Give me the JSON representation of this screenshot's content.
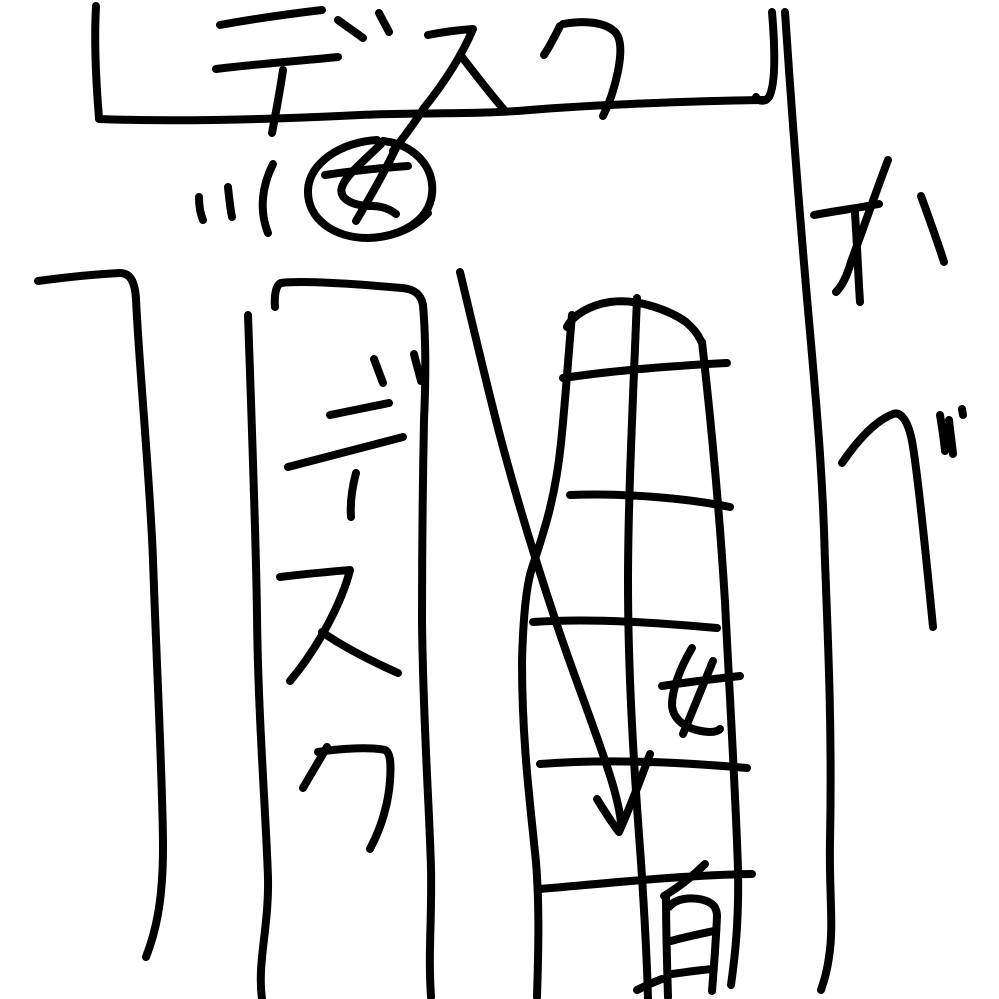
{
  "drawing": {
    "background": "#ffffff",
    "ink_color": "#000000",
    "stroke_width": 8,
    "canvas": {
      "width": 999,
      "height": 999
    },
    "labels": {
      "top_desk": "デスク",
      "circled_person": "女",
      "column_desk": "デスク",
      "wall": "かべ",
      "shelf_person": "女",
      "bottom_kanji": "有"
    },
    "strokes": [
      {
        "name": "top-desk-left-edge",
        "d": "M96,6 C94,42 96,82 99,118"
      },
      {
        "name": "top-desk-bottom-edge",
        "d": "M99,119 C180,122 280,119 360,115 C430,112 470,115 530,110 C590,105 690,101 766,100"
      },
      {
        "name": "top-desk-right-hook",
        "d": "M772,12 C775,48 776,84 769,97 C765,102 759,102 756,97"
      },
      {
        "name": "label-top-desk-de-h1",
        "d": "M220,25 C253,19 288,14 322,10"
      },
      {
        "name": "label-top-desk-de-h2",
        "d": "M216,69 C257,64 298,61 338,57"
      },
      {
        "name": "label-top-desk-de-v",
        "d": "M283,70 C280,91 276,112 272,133"
      },
      {
        "name": "label-top-desk-dakuten-1",
        "d": "M338,20 C346,26 355,32 363,38"
      },
      {
        "name": "label-top-desk-dakuten-2",
        "d": "M379,13 C382,19 386,26 389,32"
      },
      {
        "name": "label-top-desk-su",
        "d": "M428,35 C443,32 458,30 473,29 C462,55 444,83 424,108 C415,122 404,137 393,151"
      },
      {
        "name": "label-top-desk-su-leg",
        "d": "M462,57 C475,74 489,92 505,111"
      },
      {
        "name": "label-top-desk-ku-1",
        "d": "M560,26 C555,36 550,46 544,55"
      },
      {
        "name": "label-top-desk-ku-2",
        "d": "M563,24 C585,20 606,22 616,33 C622,41 621,56 618,71 C615,86 610,102 603,116"
      },
      {
        "name": "speed-line-1",
        "d": "M199,197 C199,205 200,213 203,220"
      },
      {
        "name": "speed-line-2",
        "d": "M228,187 C229,197 230,207 232,217"
      },
      {
        "name": "speed-line-3",
        "d": "M273,164 C262,186 259,210 268,233"
      },
      {
        "name": "person-circle-outline",
        "d": "M377,140 C341,142 309,163 308,190 C307,219 334,238 368,238 C401,237 429,221 432,194 C435,166 413,144 383,141"
      },
      {
        "name": "person-circle-overlap",
        "d": "M428,213 C419,223 407,230 396,233"
      },
      {
        "name": "person-circle-onna-1",
        "d": "M381,144 C365,160 346,175 342,187 C338,199 353,206 372,206 C383,206 391,210 396,214"
      },
      {
        "name": "person-circle-onna-2",
        "d": "M397,146 C385,171 371,196 356,221"
      },
      {
        "name": "person-circle-onna-3",
        "d": "M325,175 C352,171 380,168 408,166"
      },
      {
        "name": "left-desk-outline",
        "d": "M38,281 C68,277 98,274 120,273 C131,273 135,283 136,299 C139,365 150,480 153,560 C157,675 163,790 163,848 C163,903 155,934 146,957"
      },
      {
        "name": "column-desk-left-edge",
        "d": "M248,315 C252,430 256,540 257,615 C258,715 266,815 268,878 C269,928 257,962 262,999"
      },
      {
        "name": "column-desk-top-right-edge",
        "d": "M275,307 C274,295 276,285 281,283 C303,280 356,284 402,288 C414,289 421,294 423,305 C426,340 426,375 424,420 C422,520 422,570 422,620 C423,720 429,800 431,868 C432,922 428,952 431,997"
      },
      {
        "name": "label-column-dakuten-1",
        "d": "M374,359 C377,367 380,375 383,383"
      },
      {
        "name": "label-column-dakuten-2",
        "d": "M414,354 C416,363 419,372 421,381"
      },
      {
        "name": "label-column-de-h1",
        "d": "M330,415 C350,411 369,407 389,403"
      },
      {
        "name": "label-column-de-h2",
        "d": "M288,467 C326,457 365,447 403,437"
      },
      {
        "name": "label-column-de-v",
        "d": "M356,473 C352,488 350,503 351,517"
      },
      {
        "name": "label-column-su",
        "d": "M280,577 C303,574 327,572 350,570 C342,602 318,648 290,681"
      },
      {
        "name": "label-column-su-leg",
        "d": "M322,632 C345,648 371,661 398,673"
      },
      {
        "name": "label-column-ku-1",
        "d": "M327,747 C319,761 311,774 303,788"
      },
      {
        "name": "label-column-ku-2",
        "d": "M318,752 C342,748 372,747 385,750 C391,753 391,766 390,781 C388,806 380,830 370,849"
      },
      {
        "name": "shelf-left-edge",
        "d": "M572,315 C568,360 565,405 561,443 C555,502 542,537 532,568 C526,586 523,622 522,662 C522,742 530,802 536,862 C540,912 538,962 537,997"
      },
      {
        "name": "shelf-top-edge",
        "d": "M567,327 C573,315 590,305 610,302 C640,298 672,312 686,322 C693,328 698,334 701,341"
      },
      {
        "name": "shelf-right-edge",
        "d": "M702,342 C712,430 720,520 725,602 C730,702 736,802 738,870 C739,922 735,956 731,985"
      },
      {
        "name": "shelf-center-vertical",
        "d": "M637,298 C633,400 628,500 628,582 C628,682 635,782 641,862 C645,922 647,962 648,999"
      },
      {
        "name": "shelf-shelf-line-1",
        "d": "M563,378 C610,371 670,366 727,363"
      },
      {
        "name": "shelf-shelf-line-2",
        "d": "M570,495 C625,493 685,498 730,507"
      },
      {
        "name": "shelf-shelf-line-3",
        "d": "M533,622 C595,618 660,623 717,628"
      },
      {
        "name": "shelf-shelf-line-4",
        "d": "M540,764 C605,759 680,762 747,768"
      },
      {
        "name": "shelf-shelf-line-5",
        "d": "M540,889 C610,883 685,875 752,874"
      },
      {
        "name": "arrow-shaft",
        "d": "M460,272 C472,322 486,382 499,432 C516,497 536,562 556,622 C576,682 600,742 612,782 C617,799 620,812 621,823"
      },
      {
        "name": "arrow-head",
        "d": "M597,799 C605,812 612,823 619,832 C628,812 640,781 650,754"
      },
      {
        "name": "person-shelf-onna-1",
        "d": "M692,648 C680,668 672,690 672,705 C673,722 690,731 710,732 C715,732 718,731 720,729"
      },
      {
        "name": "person-shelf-onna-2",
        "d": "M713,661 C703,685 693,710 683,734"
      },
      {
        "name": "person-shelf-onna-3",
        "d": "M662,686 C688,682 714,679 740,676"
      },
      {
        "name": "bottom-kanji-stroke-1",
        "d": "M705,864 C693,876 679,887 664,896"
      },
      {
        "name": "bottom-kanji-stroke-2",
        "d": "M666,896 C666,930 667,964 668,997"
      },
      {
        "name": "bottom-kanji-stroke-3",
        "d": "M669,907 C673,902 678,900 684,899 C696,897 709,900 714,906 C716,909 717,912 717,916"
      },
      {
        "name": "bottom-kanji-stroke-4",
        "d": "M717,916 C716,941 714,966 712,991"
      },
      {
        "name": "bottom-kanji-stroke-5",
        "d": "M671,941 C685,937 700,934 714,931"
      },
      {
        "name": "bottom-kanji-stroke-6",
        "d": "M672,974 C686,972 700,970 713,969"
      },
      {
        "name": "bottom-kanji-stroke-7",
        "d": "M637,990 C645,986 654,982 662,979"
      },
      {
        "name": "wall-line",
        "d": "M785,12 C791,102 801,232 810,332 C818,422 823,482 825,562 C829,662 832,742 830,842 C829,892 834,927 829,957 C827,972 824,981 821,990"
      },
      {
        "name": "label-wall-ka-1",
        "d": "M888,160 C878,186 862,232 851,262 C847,276 842,286 836,292"
      },
      {
        "name": "label-wall-ka-2",
        "d": "M814,215 C836,211 857,208 879,204"
      },
      {
        "name": "label-wall-ka-3",
        "d": "M855,213 C857,243 858,272 860,302"
      },
      {
        "name": "label-wall-ka-4",
        "d": "M921,196 C929,218 937,240 944,262"
      },
      {
        "name": "label-wall-be",
        "d": "M842,463 C857,441 875,421 893,414 C901,411 908,421 912,441 C917,468 925,545 933,627"
      },
      {
        "name": "label-wall-be-dakuten-1",
        "d": "M940,415 C942,427 944,439 945,451"
      },
      {
        "name": "label-wall-be-dakuten-2",
        "d": "M949,420 C950,431 952,443 953,454"
      },
      {
        "name": "label-wall-be-dot",
        "d": "M962,409 C962,411 963,413 963,415"
      }
    ]
  }
}
